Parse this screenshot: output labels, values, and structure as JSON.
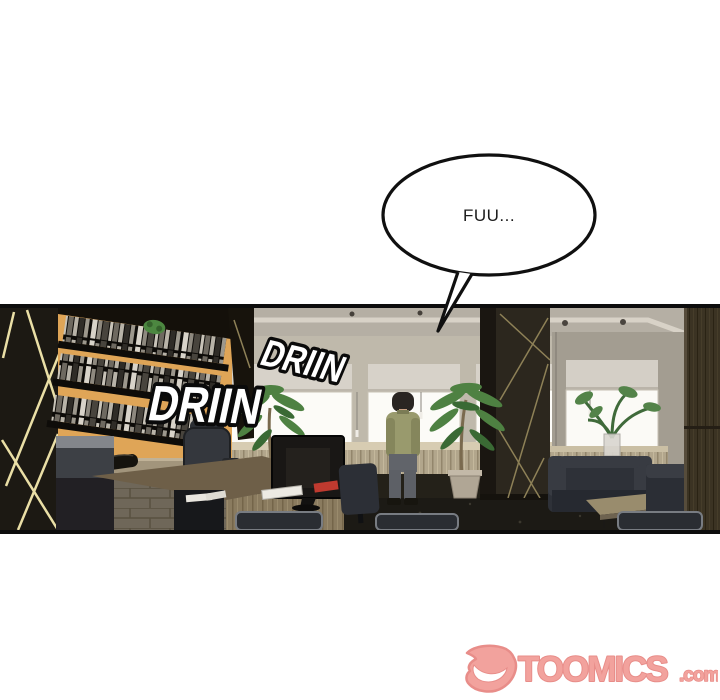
{
  "page": {
    "background": "#ffffff",
    "description": "Webtoon comic panel: office interior, man standing at window"
  },
  "speech_bubble": {
    "text": "FUU..."
  },
  "sfx": [
    {
      "text": "DRIIN"
    },
    {
      "text": "DRIIN"
    }
  ],
  "panel": {
    "border_color": "#0d0d0d",
    "colors": {
      "orange_wall": "#dfa557",
      "gold_accent_lines": "#eadfa6",
      "ceiling": "#b5afa4",
      "window": "#fcfbf7",
      "blind": "#d7d2c9",
      "floor": "#242119",
      "man_shirt": "#999a6d",
      "man_pants": "#5d6066",
      "sofa": "#2e3138"
    }
  },
  "footer_logo": {
    "site_name": "TOOMICS",
    "domain_suffix": ".com",
    "color": "#f2a29d",
    "outline_color": "#e88d89"
  }
}
